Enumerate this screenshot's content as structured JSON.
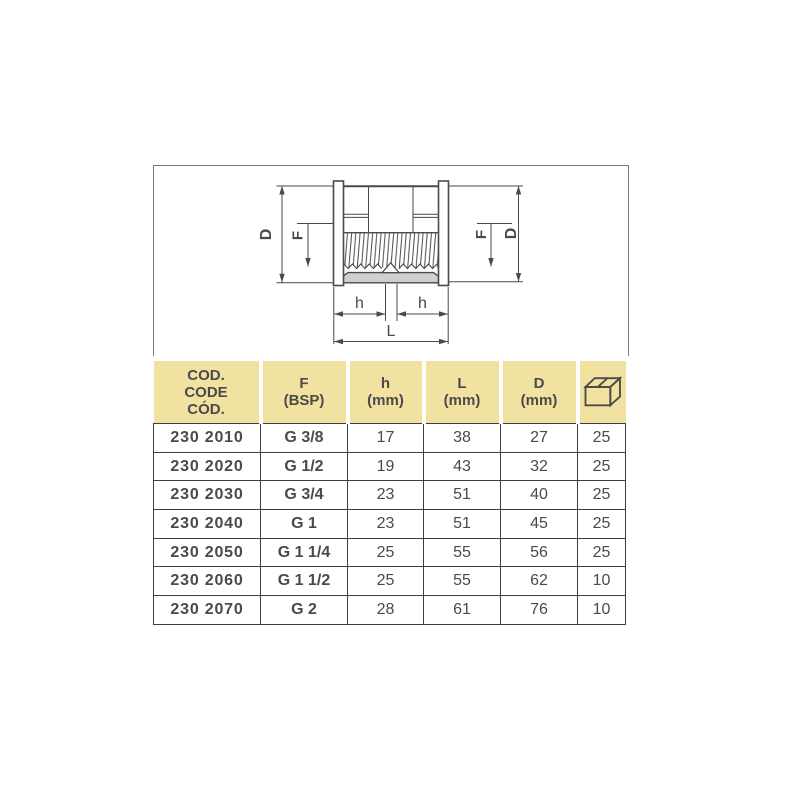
{
  "drawing": {
    "description": "cross-section technical drawing of a female threaded socket fitting",
    "dimension_labels": {
      "d_left": "D",
      "f_left": "F",
      "f_right": "F",
      "d_right": "D",
      "h_left": "h",
      "h_right": "h",
      "length": "L"
    },
    "colors": {
      "line": "#4a4a4a",
      "section_fill": "#cfcfcf",
      "frame_border": "#7a7a7a"
    }
  },
  "table": {
    "colors": {
      "header_background": "#f1e2a2",
      "border": "#3e3e3e",
      "text": "#4a4a4a"
    },
    "header": {
      "code_lines": [
        "COD.",
        "CODE",
        "CÓD."
      ],
      "f_label": "F",
      "f_unit": "(BSP)",
      "h_label": "h",
      "h_unit": "(mm)",
      "l_label": "L",
      "l_unit": "(mm)",
      "d_label": "D",
      "d_unit": "(mm)",
      "qty_icon": "packaging-box-icon"
    },
    "rows": [
      {
        "code": "230 2010",
        "f": "G 3/8",
        "h": "17",
        "l": "38",
        "d": "27",
        "qty": "25"
      },
      {
        "code": "230 2020",
        "f": "G 1/2",
        "h": "19",
        "l": "43",
        "d": "32",
        "qty": "25"
      },
      {
        "code": "230 2030",
        "f": "G 3/4",
        "h": "23",
        "l": "51",
        "d": "40",
        "qty": "25"
      },
      {
        "code": "230 2040",
        "f": "G 1",
        "h": "23",
        "l": "51",
        "d": "45",
        "qty": "25"
      },
      {
        "code": "230 2050",
        "f": "G 1 1/4",
        "h": "25",
        "l": "55",
        "d": "56",
        "qty": "25"
      },
      {
        "code": "230 2060",
        "f": "G 1 1/2",
        "h": "25",
        "l": "55",
        "d": "62",
        "qty": "10"
      },
      {
        "code": "230 2070",
        "f": "G 2",
        "h": "28",
        "l": "61",
        "d": "76",
        "qty": "10"
      }
    ]
  }
}
